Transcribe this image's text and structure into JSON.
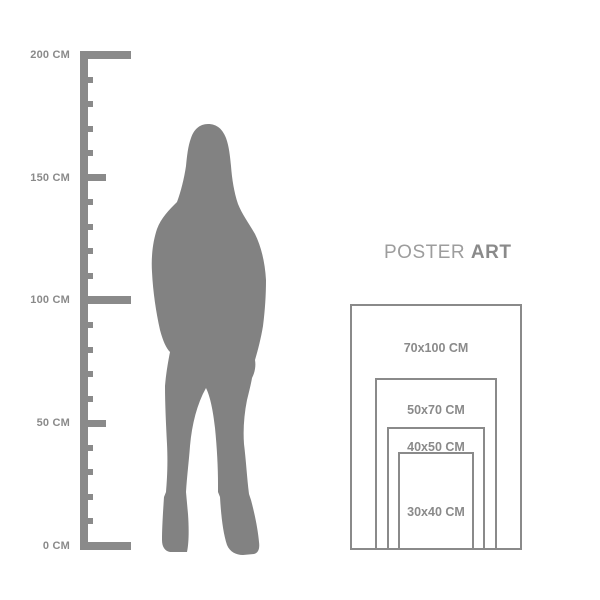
{
  "brand": {
    "name_regular": "POSTER",
    "name_bold": "ART"
  },
  "ruler": {
    "unit": "CM",
    "labels": [
      {
        "value": 200,
        "text": "200 CM"
      },
      {
        "value": 150,
        "text": "150 CM"
      },
      {
        "value": 100,
        "text": "100 CM"
      },
      {
        "value": 50,
        "text": "50 CM"
      },
      {
        "value": 0,
        "text": "0 CM"
      }
    ]
  },
  "silhouette": {
    "subject": "standing-woman",
    "color": "#828282"
  },
  "poster_sizes": [
    {
      "label": "70x100 CM",
      "width_cm": 70,
      "height_cm": 100
    },
    {
      "label": "50x70 CM",
      "width_cm": 50,
      "height_cm": 70
    },
    {
      "label": "40x50 CM",
      "width_cm": 40,
      "height_cm": 50
    },
    {
      "label": "30x40 CM",
      "width_cm": 30,
      "height_cm": 40
    }
  ],
  "colors": {
    "ruler": "#8a8a8a",
    "silhouette": "#828282",
    "frame_border": "#8a8a8a",
    "label_text": "#8a8a8a",
    "brand_regular": "#9d9d9d",
    "brand_bold": "#8a8a8a",
    "background": "#ffffff"
  }
}
